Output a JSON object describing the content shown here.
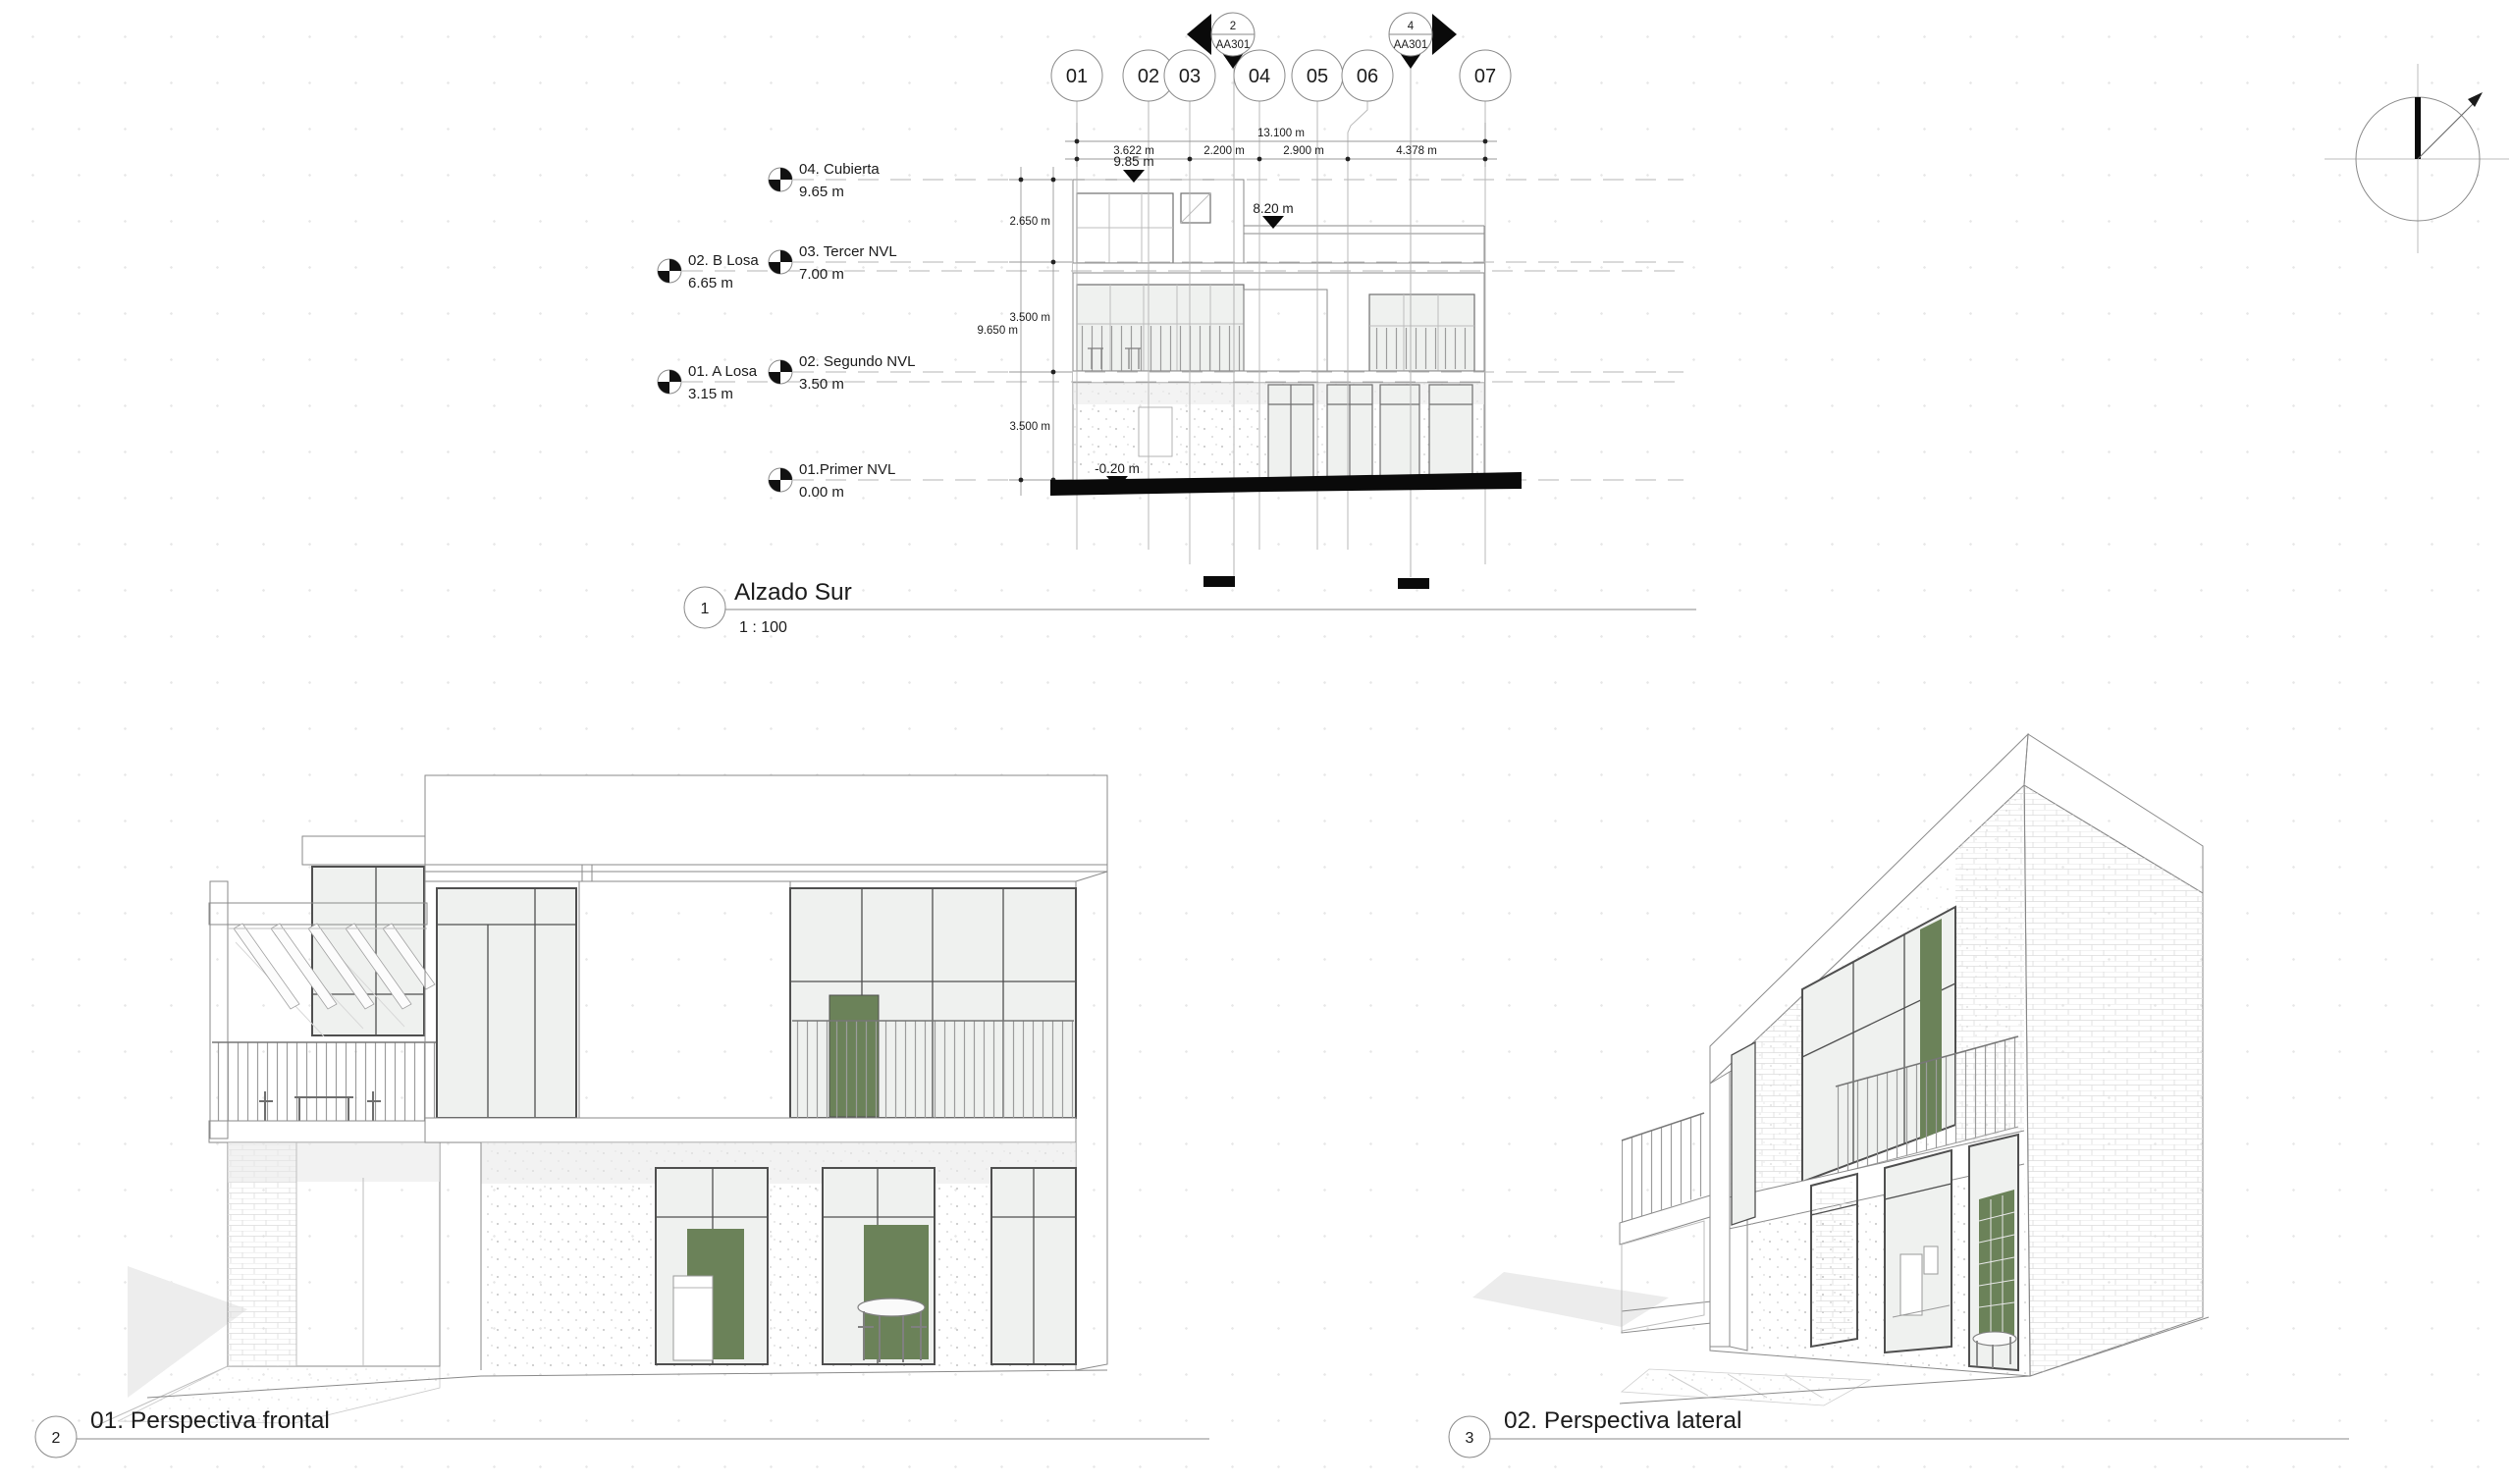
{
  "colors": {
    "accent_green": "#6b8259",
    "drawing_line": "#8a8a8a",
    "text": "#1b1b1b",
    "ground_black": "#0a0a0a"
  },
  "elevation_view": {
    "number": "1",
    "title": "Alzado Sur",
    "scale": "1 : 100",
    "grids": [
      {
        "label": "01"
      },
      {
        "label": "02"
      },
      {
        "label": "03"
      },
      {
        "label": "04"
      },
      {
        "label": "05"
      },
      {
        "label": "06"
      },
      {
        "label": "07"
      }
    ],
    "sections": [
      {
        "detail_number": "2",
        "sheet_number": "AA301"
      },
      {
        "detail_number": "4",
        "sheet_number": "AA301"
      }
    ],
    "levels": [
      {
        "name": "04. Cubierta",
        "elevation": "9.65 m"
      },
      {
        "name": "03. Tercer NVL",
        "elevation": "7.00 m"
      },
      {
        "name": "02. B Losa",
        "elevation": "6.65 m"
      },
      {
        "name": "02. Segundo NVL",
        "elevation": "3.50 m"
      },
      {
        "name": "01. A Losa",
        "elevation": "3.15 m"
      },
      {
        "name": "01.Primer NVL",
        "elevation": "0.00 m"
      }
    ],
    "dim_overall": "13.100 m",
    "dim_segments": [
      "3.622 m",
      "2.200 m",
      "2.900 m",
      "4.378 m"
    ],
    "dim_heights": [
      "2.650 m",
      "3.500 m",
      "3.500 m"
    ],
    "dim_height_overall": "9.650 m",
    "spot_elevations": {
      "parapet": "9.85 m",
      "roof": "8.20 m",
      "ground": "-0.20 m"
    }
  },
  "frontal_view": {
    "number": "2",
    "title": "01. Perspectiva frontal"
  },
  "lateral_view": {
    "number": "3",
    "title": "02. Perspectiva lateral"
  }
}
